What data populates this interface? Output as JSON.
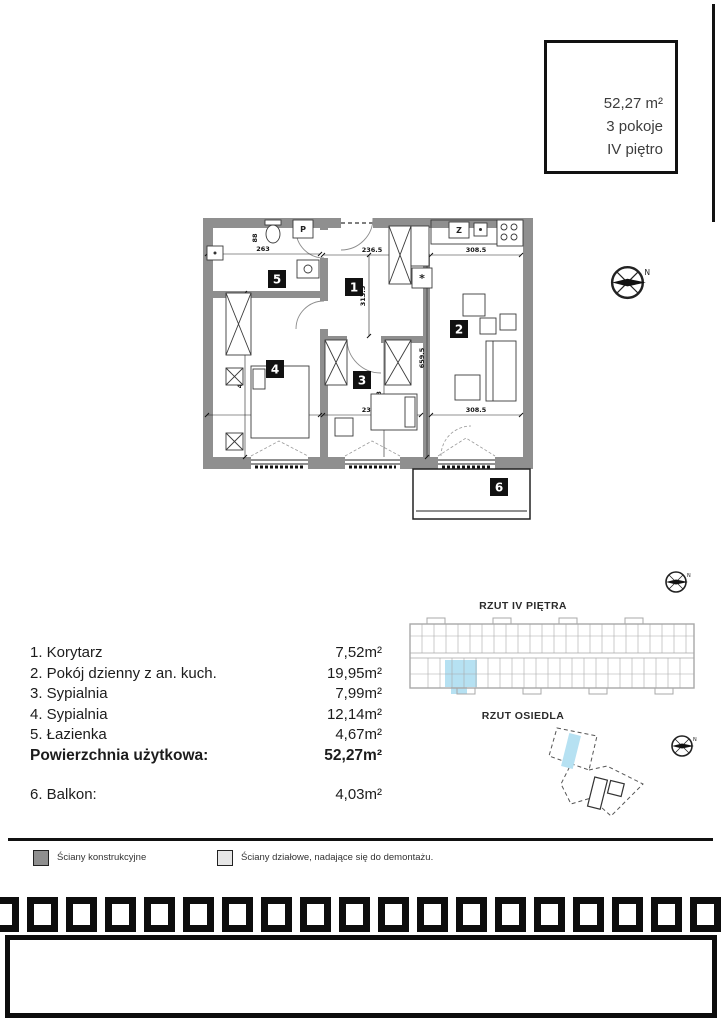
{
  "info_box": {
    "area": "52,27 m²",
    "rooms": "3 pokoje",
    "floor": "IV piętro"
  },
  "plan": {
    "badges": [
      "1",
      "2",
      "3",
      "4",
      "5",
      "6"
    ],
    "dims": {
      "top_left": "263",
      "left_small": "88",
      "top_mid": "236.5",
      "mid_vert": "313.5",
      "top_right": "308.5",
      "right_vert": "659.5",
      "left_vert": "461.5",
      "bottom_left": "263",
      "bottom_mid": "236.5",
      "mid_vert2": "338",
      "bottom_right": "308.5"
    },
    "fixture_labels": {
      "washer": "P",
      "sink": "Z",
      "meter": "*"
    }
  },
  "room_list": {
    "items": [
      {
        "name": "1. Korytarz",
        "area": "7,52m²"
      },
      {
        "name": "2. Pokój dzienny z an. kuch.",
        "area": "19,95m²"
      },
      {
        "name": "3. Sypialnia",
        "area": "7,99m²"
      },
      {
        "name": "4. Sypialnia",
        "area": "12,14m²"
      },
      {
        "name": "5. Łazienka",
        "area": "4,67m²"
      }
    ],
    "total": {
      "name": "Powierzchnia użytkowa:",
      "area": "52,27m²"
    },
    "balcony": {
      "name": "6. Balkon:",
      "area": "4,03m²"
    }
  },
  "side_views": {
    "floor_title": "RZUT IV PIĘTRA",
    "estate_title": "RZUT OSIEDLA"
  },
  "legend": {
    "structural": "Ściany konstrukcyjne",
    "partition": "Ściany działowe, nadające się do demontażu."
  },
  "colors": {
    "wall": "#8f8f8f",
    "highlight": "#b6e1f2",
    "legend_structural": "#8f8f8f",
    "legend_partition": "#e6e6e6",
    "line_black": "#111111"
  }
}
